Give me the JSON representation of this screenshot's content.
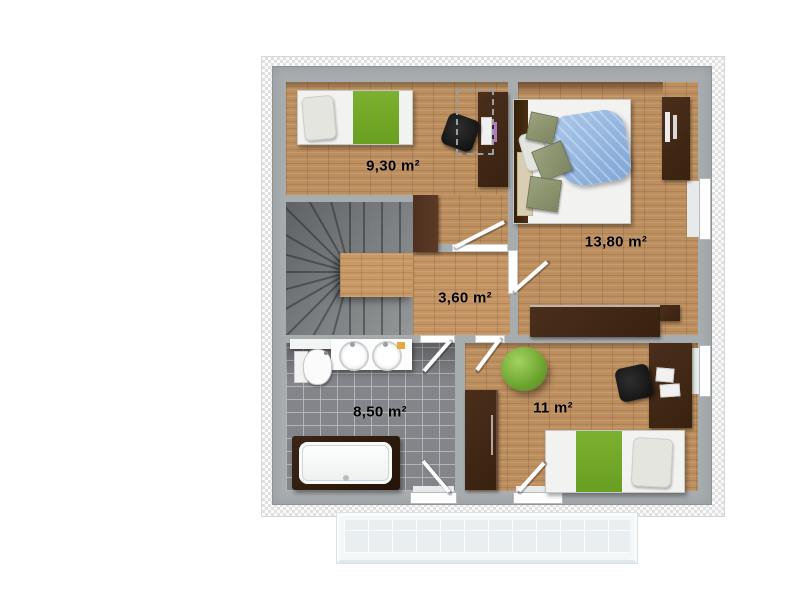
{
  "plan_type": "floor-plan-upper-storey",
  "rooms": {
    "bedroom_top_left": {
      "name": "bedroom-top-left",
      "label": "9,30 m²"
    },
    "bedroom_top_right": {
      "name": "bedroom-top-right",
      "label": "13,80 m²"
    },
    "hallway": {
      "name": "hallway",
      "label": "3,60 m²"
    },
    "bathroom": {
      "name": "bathroom",
      "label": "8,50 m²"
    },
    "bedroom_bottom_right": {
      "name": "bedroom-bottom-right",
      "label": "11 m²"
    }
  },
  "furniture": {
    "bedroom_top_left": [
      "single-bed-green-blanket",
      "desk",
      "office-chair"
    ],
    "bedroom_top_right": [
      "double-bed",
      "wall-shelf",
      "sideboard"
    ],
    "bathroom": [
      "double-washbasin-vanity",
      "toilet",
      "bathtub"
    ],
    "bedroom_bottom_right": [
      "single-bed-green-blanket",
      "wardrobe",
      "desk",
      "office-chair",
      "beanbag-chair"
    ],
    "hallway": [
      "winder-staircase",
      "chimney-block"
    ]
  },
  "colors": {
    "wall": "#a7acaf",
    "insulation_hatch": "#e0e0e0",
    "wood_floor": "#bd8f5f",
    "stairs": "#7c8083",
    "bathroom_tile": "#84858a",
    "accent_green": "#74aa28",
    "blanket_blue": "#8fa6d6",
    "furniture_dark_wood": "#40281a",
    "balcony": "#f3f7f8",
    "label_text": "#000000"
  }
}
